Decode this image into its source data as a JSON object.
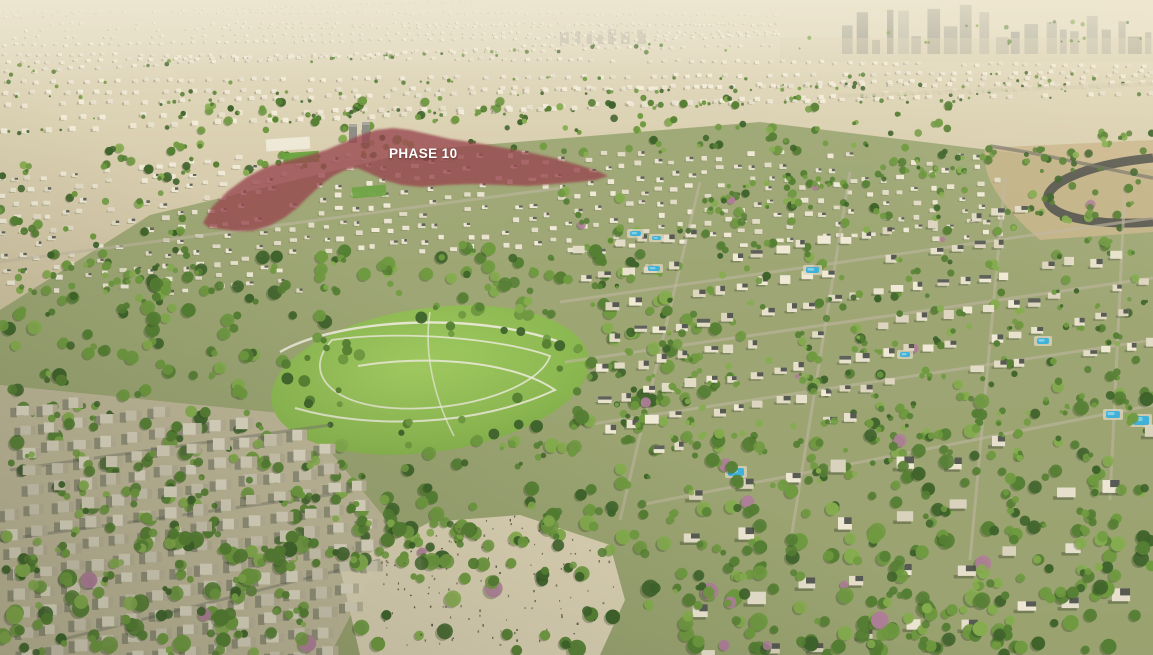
{
  "annotation": {
    "label": "PHASE 10",
    "text_color": "#ffffff"
  },
  "phase_overlay": {
    "fill": "#97454e",
    "opacity": 0.78
  },
  "palette": {
    "sand_light": "#ddd3b6",
    "sand_mid": "#cfc3a2",
    "sand_shadow": "#b5aa8e",
    "haze": "#eee7d2",
    "skyline_tower": "#a9a89c",
    "tree_dark": "#3e632b",
    "tree_mid": "#557f33",
    "tree_light": "#6f9a40",
    "tree_highlight": "#85ad4e",
    "flowering_tree": "#b07f9a",
    "lawn": "#8cb851",
    "path_white": "#edebdc",
    "villa_wall": "#e7e0cc",
    "villa_roof_dark": "#474b45",
    "grey_house": "#cdc6b2",
    "street_light": "#beb6a0",
    "street_dark": "#7a796c",
    "pool_blue": "#41b1d8",
    "pool_light": "#8fd8ec",
    "road_asphalt": "#56564f",
    "highway_sand": "#c9b58c"
  }
}
